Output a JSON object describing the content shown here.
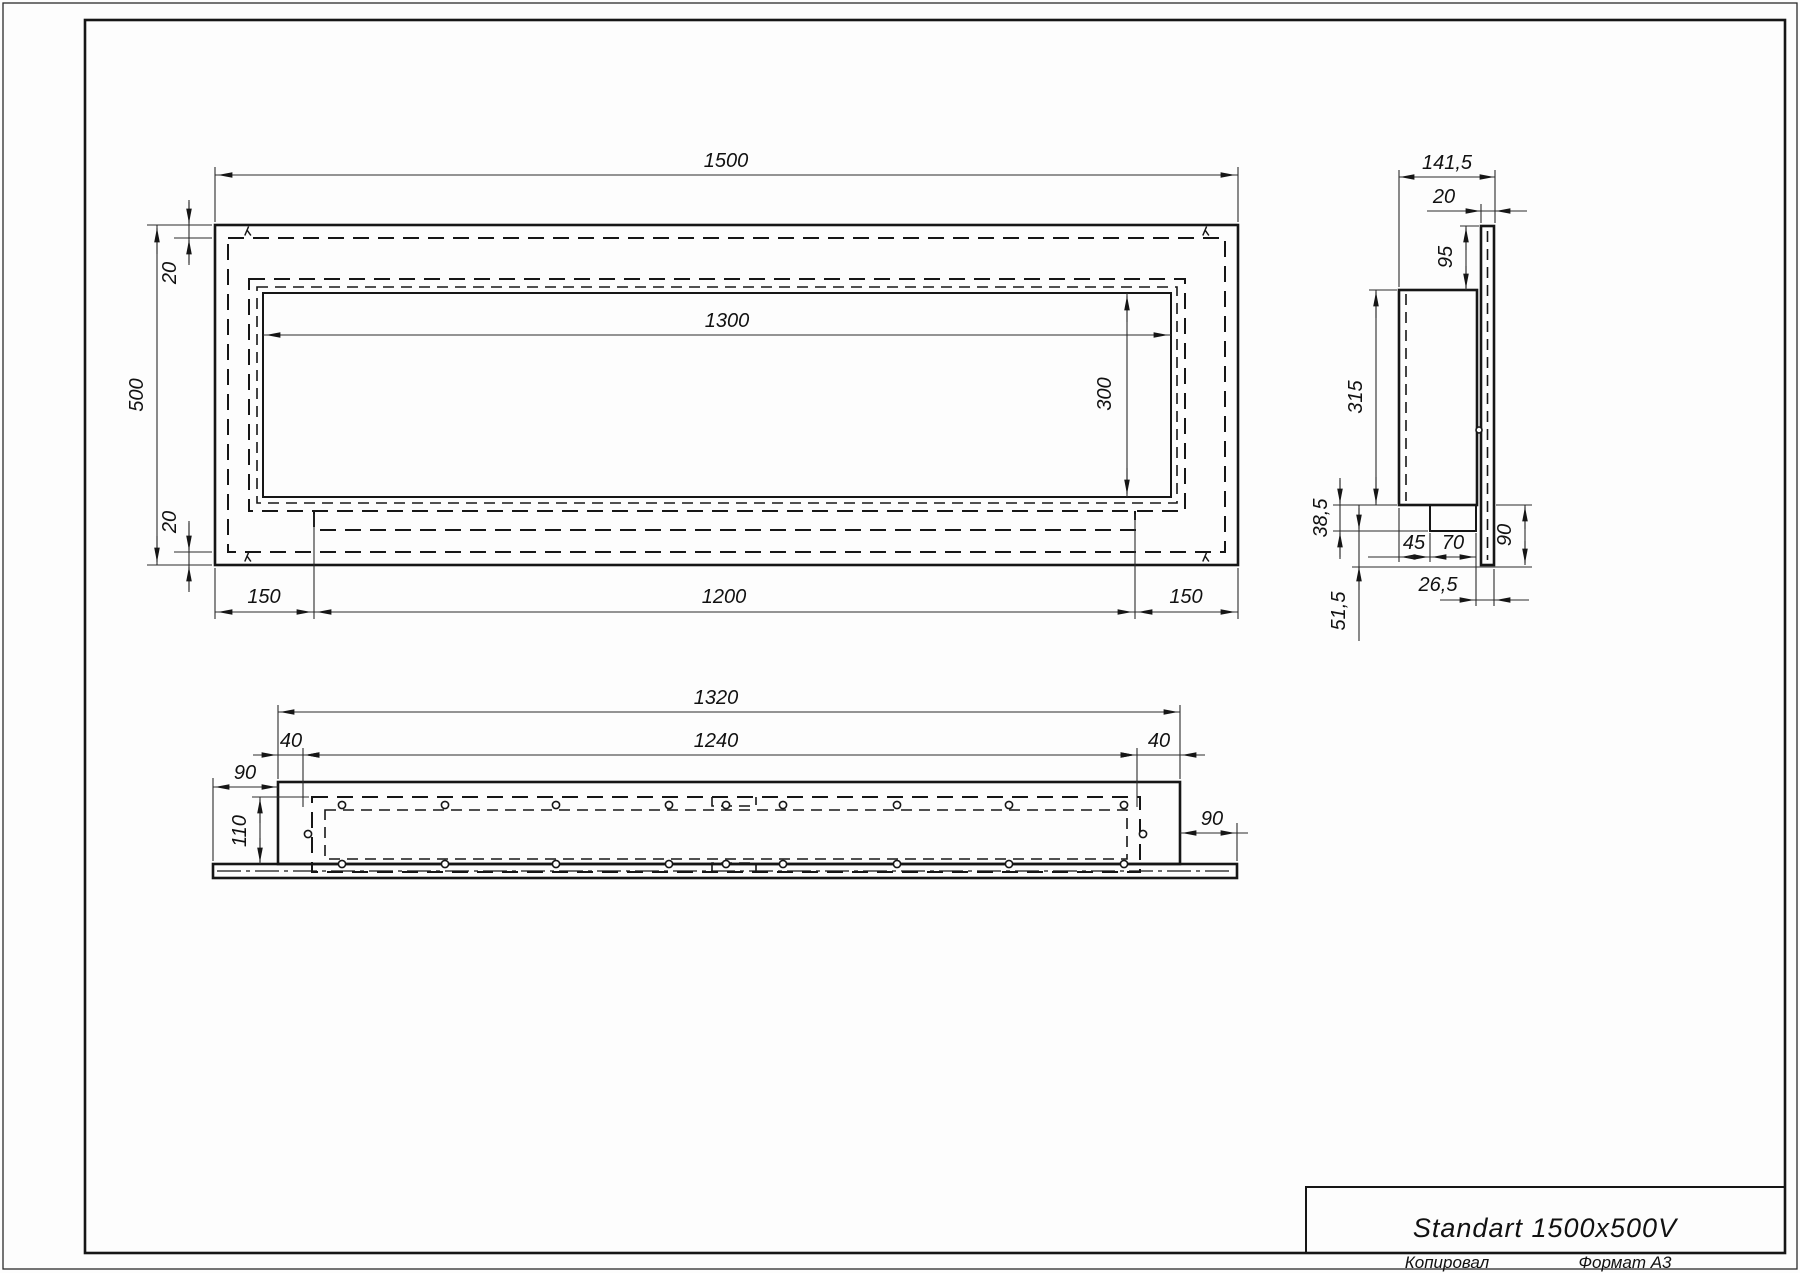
{
  "title_block": {
    "name": "Standart 1500x500V",
    "copied_label": "Копировал",
    "format_label": "Формат А3"
  },
  "front_view": {
    "overall_width": "1500",
    "overall_height": "500",
    "top_flange": "20",
    "bottom_flange": "20",
    "opening_width": "1300",
    "opening_height": "300",
    "left_offset": "150",
    "tray_width": "1200",
    "right_offset": "150"
  },
  "side_view": {
    "overall_depth": "141,5",
    "panel_thickness": "20",
    "top_to_body": "95",
    "body_height": "315",
    "shelf_height": "38,5",
    "bottom_height": "51,5",
    "shelf_inset": "45",
    "tray_depth": "70",
    "panel_bottom_height": "90",
    "panel_offset": "26,5"
  },
  "bottom_view": {
    "body_width": "1320",
    "inner_width": "1240",
    "left_inset": "40",
    "right_inset": "40",
    "left_margin": "90",
    "body_depth": "110",
    "right_margin": "90"
  }
}
